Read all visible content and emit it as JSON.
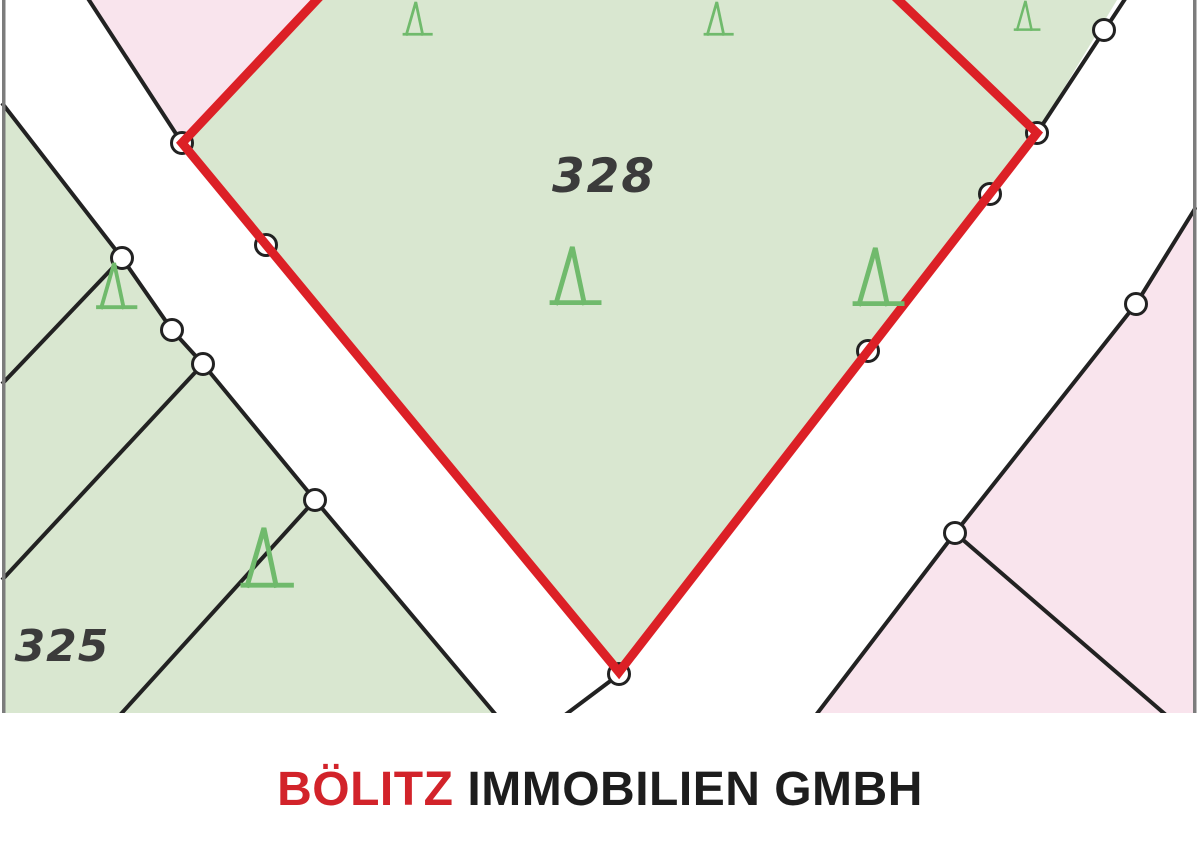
{
  "map": {
    "labels": {
      "main_parcel": "328",
      "left_parcel": "325"
    },
    "legend": {
      "highlighted_parcel": "328",
      "boundary_point_icon": "boundary-point",
      "tree_icon": "conifer-tree-icon"
    }
  },
  "footer": {
    "brand": "BÖLITZ",
    "company_suffix": "IMMOBILIEN GMBH"
  },
  "colors": {
    "parcel_green": "#d9e7d0",
    "parcel_pink": "#f9e4ed",
    "road_white": "#ffffff",
    "outline_red": "#dc2026",
    "line_black": "#222222",
    "tree_green": "#70ba6c",
    "label_gray": "#3b3b3b",
    "border_gray": "#7c7c7c",
    "brand_red": "#d2232a",
    "brand_dark": "#1d1d1d"
  }
}
